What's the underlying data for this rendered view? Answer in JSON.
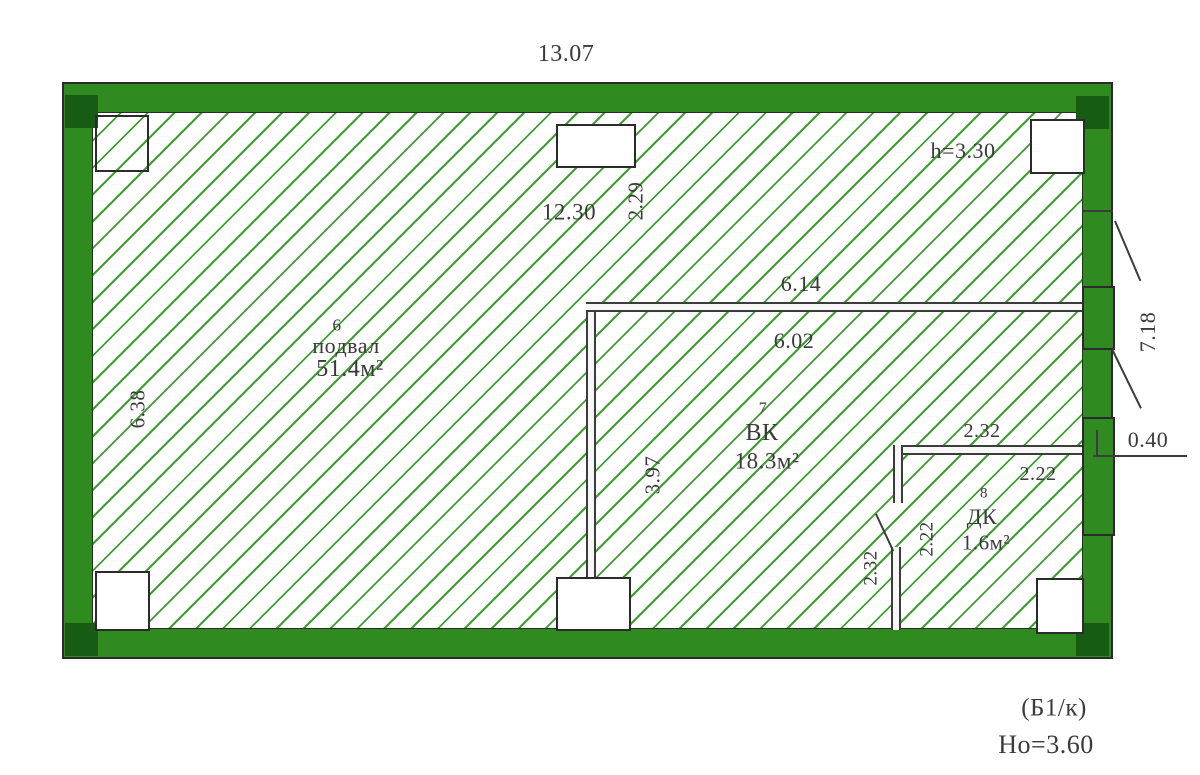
{
  "drawing": {
    "type": "floor-plan",
    "hatch_style": "diagonal-green",
    "colors": {
      "wall_green": "#2f8a1f",
      "wall_corner_dark": "#175c13",
      "hatch_line": "#3f9e31",
      "outline": "#2b2b2b",
      "text": "#3a3a3a"
    }
  },
  "rooms": [
    {
      "number": "6",
      "name": "подвал",
      "area": "51.4м²"
    },
    {
      "number": "7",
      "name": "ВК",
      "area": "18.3м²"
    },
    {
      "number": "8",
      "name": "ДК",
      "area": "1.6м²"
    }
  ],
  "dimensions": {
    "overall_width": "13.07",
    "ceiling_height": "h=3.30",
    "top_inner": "12.30",
    "top_inner_vert": "2.29",
    "left_inner": "6.38",
    "vk_top_outer": "6.14",
    "vk_top_inner": "6.02",
    "vk_left": "3.97",
    "right_outer": "7.18",
    "wall_thickness": "0.40",
    "dk_top_outer": "2.32",
    "dk_top_inner": "2.22",
    "dk_left_outer": "2.32",
    "dk_left_inner": "2.22"
  },
  "footer": {
    "section_label": "(Б1/к)",
    "height_label": "Но=3.60"
  }
}
